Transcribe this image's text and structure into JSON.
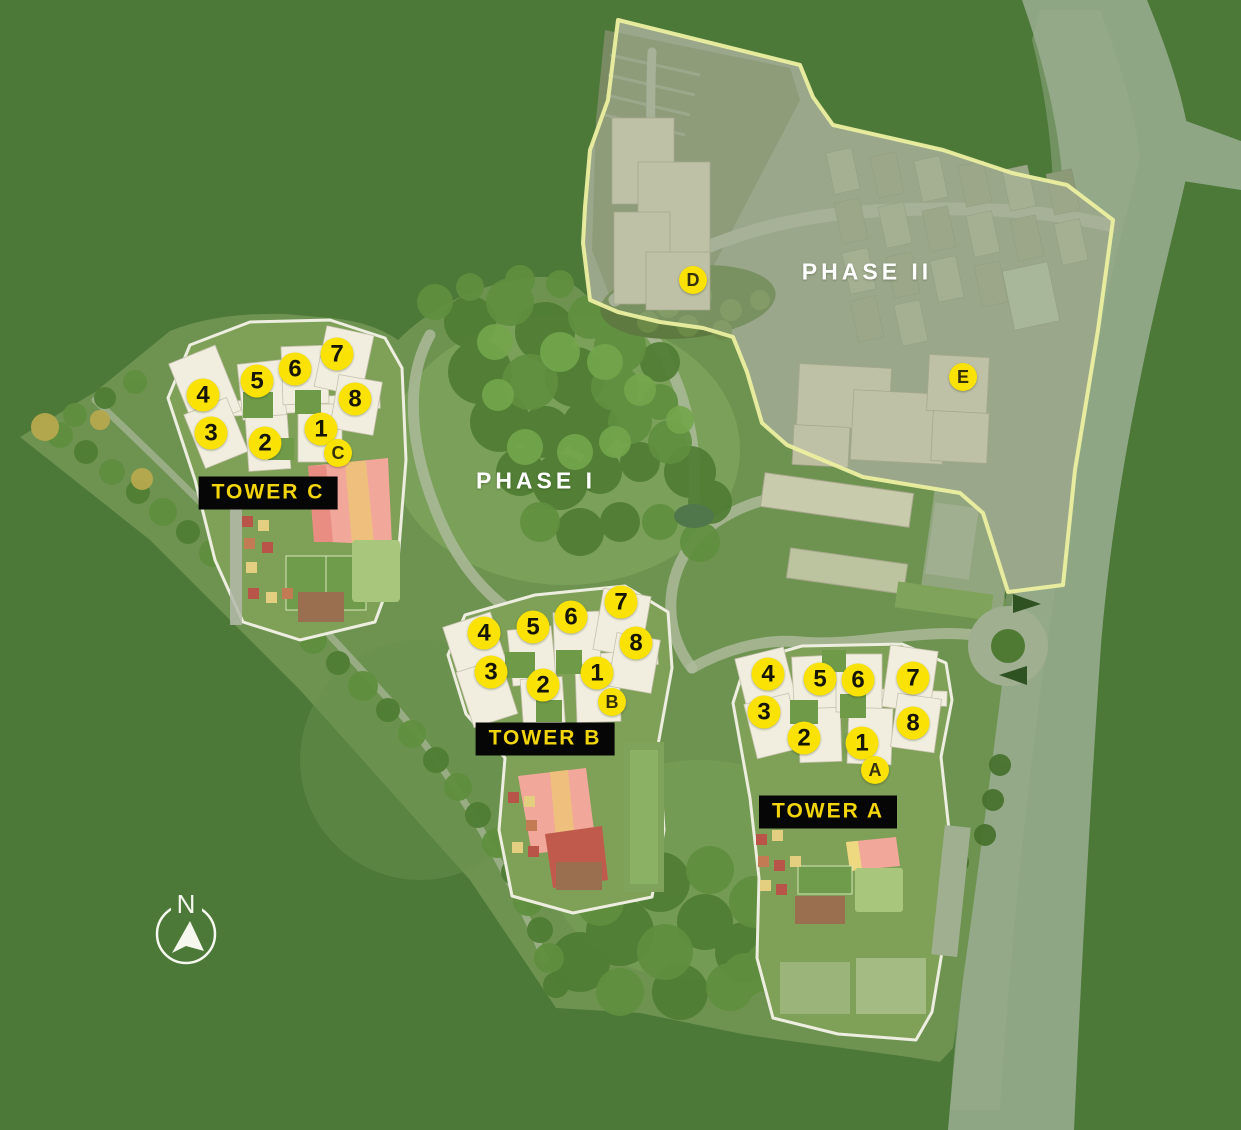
{
  "labels": {
    "phase1": {
      "text": "PHASE I",
      "x": 536,
      "y": 481
    },
    "phase2": {
      "text": "PHASE II",
      "x": 867,
      "y": 272
    }
  },
  "towers": [
    {
      "id": "tower-c",
      "name": "TOWER C",
      "label": {
        "x": 268,
        "y": 493
      },
      "entry": {
        "letter": "C",
        "x": 338,
        "y": 453
      },
      "units": [
        {
          "n": "1",
          "x": 321,
          "y": 429
        },
        {
          "n": "2",
          "x": 265,
          "y": 443
        },
        {
          "n": "3",
          "x": 211,
          "y": 433
        },
        {
          "n": "4",
          "x": 203,
          "y": 395
        },
        {
          "n": "5",
          "x": 257,
          "y": 381
        },
        {
          "n": "6",
          "x": 295,
          "y": 369
        },
        {
          "n": "7",
          "x": 337,
          "y": 354
        },
        {
          "n": "8",
          "x": 355,
          "y": 399
        }
      ]
    },
    {
      "id": "tower-b",
      "name": "TOWER B",
      "label": {
        "x": 545,
        "y": 739
      },
      "entry": {
        "letter": "B",
        "x": 612,
        "y": 702
      },
      "units": [
        {
          "n": "1",
          "x": 597,
          "y": 673
        },
        {
          "n": "2",
          "x": 543,
          "y": 685
        },
        {
          "n": "3",
          "x": 491,
          "y": 672
        },
        {
          "n": "4",
          "x": 484,
          "y": 633
        },
        {
          "n": "5",
          "x": 533,
          "y": 627
        },
        {
          "n": "6",
          "x": 571,
          "y": 617
        },
        {
          "n": "7",
          "x": 621,
          "y": 602
        },
        {
          "n": "8",
          "x": 636,
          "y": 643
        }
      ]
    },
    {
      "id": "tower-a",
      "name": "TOWER A",
      "label": {
        "x": 828,
        "y": 812
      },
      "entry": {
        "letter": "A",
        "x": 875,
        "y": 770
      },
      "units": [
        {
          "n": "1",
          "x": 862,
          "y": 743
        },
        {
          "n": "2",
          "x": 804,
          "y": 738
        },
        {
          "n": "3",
          "x": 764,
          "y": 712
        },
        {
          "n": "4",
          "x": 768,
          "y": 674
        },
        {
          "n": "5",
          "x": 820,
          "y": 679
        },
        {
          "n": "6",
          "x": 858,
          "y": 680
        },
        {
          "n": "7",
          "x": 913,
          "y": 678
        },
        {
          "n": "8",
          "x": 913,
          "y": 723
        }
      ]
    }
  ],
  "phase_markers": [
    {
      "letter": "D",
      "x": 693,
      "y": 280
    },
    {
      "letter": "E",
      "x": 963,
      "y": 377
    }
  ],
  "compass": {
    "letter": "N",
    "x": 186,
    "y": 934
  },
  "colors": {
    "background": "#4C7838",
    "road": "#8FA685",
    "site_green": "#6E9351",
    "marker_fill": "#F9E204",
    "marker_text": "#151502",
    "tower_label_bg": "#060606",
    "tower_label_text": "#F2D50C",
    "phase_label_text": "#FFFFFF",
    "phase2_boundary": "#ECEFA0"
  }
}
